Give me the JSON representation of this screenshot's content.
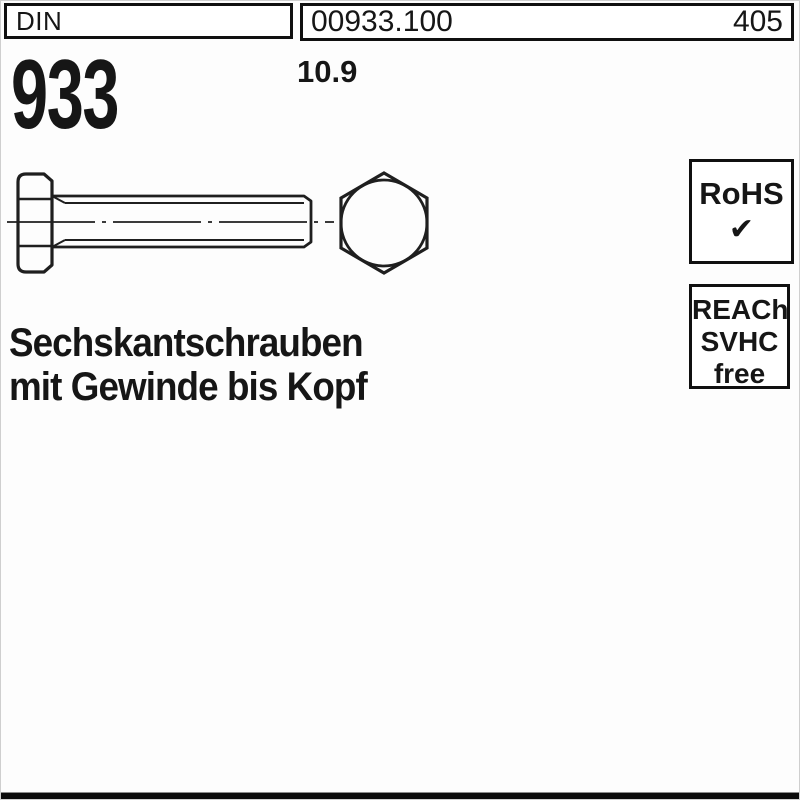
{
  "window": {
    "background": "#fdfdfd",
    "ink_color": "#161616",
    "box_border_color": "#101010",
    "drawing_stroke_color": "#1f1f1f",
    "bottom_bar_color": "#0b0b0b"
  },
  "header": {
    "din_label": "DIN",
    "article_number": "00933.100",
    "catalog_page": "405"
  },
  "standard": {
    "number": "933",
    "strength_class": "10.9"
  },
  "title": {
    "line1": "Sechskantschrauben",
    "line2": "mit Gewinde bis Kopf"
  },
  "badges": {
    "rohs_label": "RoHS",
    "rohs_check": "✔",
    "reach_line1": "REACh",
    "reach_line2": "SVHC",
    "reach_line3": "free"
  },
  "drawing": {
    "side_view": "hex-bolt-side-view",
    "front_view": "hex-bolt-front-view"
  }
}
